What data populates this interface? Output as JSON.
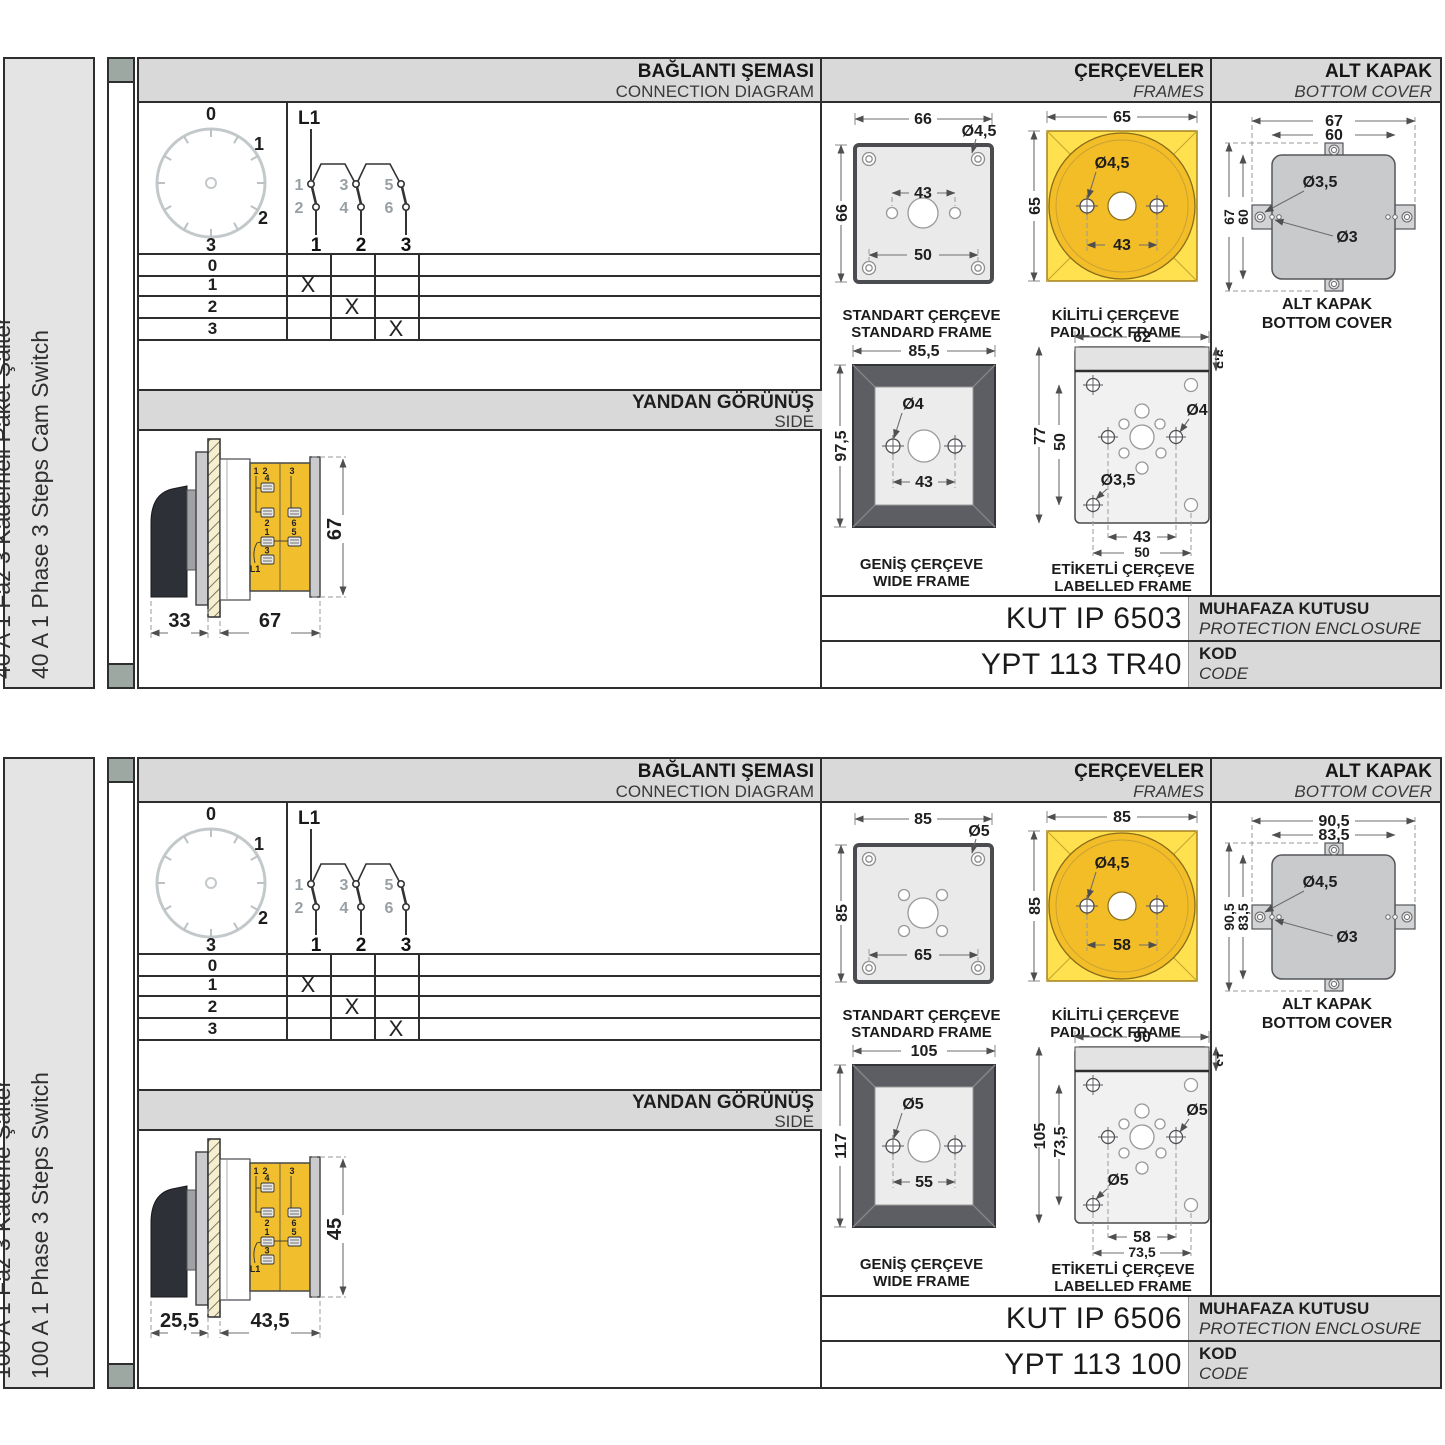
{
  "panels": [
    {
      "side_label_tr": "40 A 1 Faz 3 Kademeli Paket Şalter",
      "side_label_en": "40 A 1 Phase 3 Steps Cam Switch",
      "headers": {
        "connection_tr": "BAĞLANTI ŞEMASI",
        "connection_en": "CONNECTION DIAGRAM",
        "frames_tr": "ÇERÇEVELER",
        "frames_en": "FRAMES",
        "cover_tr": "ALT KAPAK",
        "cover_en": "BOTTOM COVER",
        "side_tr": "YANDAN GÖRÜNÜŞ",
        "side_en": "SIDE"
      },
      "dial": {
        "p0": "0",
        "p1": "1",
        "p2": "2",
        "p3": "3"
      },
      "circuit": {
        "source": "L1",
        "t1": "1",
        "t3": "3",
        "t5": "5",
        "b2": "2",
        "b4": "4",
        "b6": "6",
        "pole1": "1",
        "pole2": "2",
        "pole3": "3"
      },
      "table": {
        "rows": [
          {
            "pos": "0",
            "c1": "",
            "c2": "",
            "c3": ""
          },
          {
            "pos": "1",
            "c1": "X",
            "c2": "",
            "c3": ""
          },
          {
            "pos": "2",
            "c1": "",
            "c2": "X",
            "c3": ""
          },
          {
            "pos": "3",
            "c1": "",
            "c2": "",
            "c3": "X"
          }
        ]
      },
      "side_view": {
        "dim_front": "33",
        "dim_body": "67",
        "dim_height": "67",
        "lbl_1": "1",
        "lbl_2": "2",
        "lbl_3top": "3",
        "lbl_4": "4",
        "lbl_2b": "2",
        "lbl_6": "6",
        "lbl_1b": "1",
        "lbl_5": "5",
        "lbl_3b": "3",
        "lbl_l1": "L1"
      },
      "frames": {
        "standard": {
          "cap_tr": "STANDART ÇERÇEVE",
          "cap_en": "STANDARD FRAME",
          "dim_w": "66",
          "dim_h": "66",
          "dim_hole": "Ø4,5",
          "dim_mid": "43",
          "dim_bottom": "50"
        },
        "padlock": {
          "cap_tr": "KİLİTLİ ÇERÇEVE",
          "cap_en": "PADLOCK FRAME",
          "dim_w": "65",
          "dim_h": "65",
          "dim_hole": "Ø4,5",
          "dim_span": "43"
        },
        "wide": {
          "cap_tr": "GENİŞ ÇERÇEVE",
          "cap_en": "WIDE FRAME",
          "dim_w": "85,5",
          "dim_h": "97,5",
          "dim_hole": "Ø4",
          "dim_span": "43"
        },
        "labelled": {
          "cap_tr": "ETİKETLİ ÇERÇEVE",
          "cap_en": "LABELLED FRAME",
          "dim_w": "62",
          "dim_strip": "9,5",
          "dim_h": "77",
          "dim_inner": "50",
          "dim_hole_mid": "Ø4",
          "dim_hole_corner": "Ø3,5",
          "dim_span_mid": "43",
          "dim_span_corner": "50"
        }
      },
      "cover": {
        "cap_tr": "ALT KAPAK",
        "cap_en": "BOTTOM COVER",
        "dim_ow": "67",
        "dim_iw": "60",
        "dim_oh": "67",
        "dim_ih": "60",
        "dim_hole_big": "Ø3,5",
        "dim_hole_small": "Ø3"
      },
      "enclosure": {
        "value": "KUT IP 6503",
        "label_tr": "MUHAFAZA KUTUSU",
        "label_en": "PROTECTION ENCLOSURE"
      },
      "code": {
        "value": "YPT 113 TR40",
        "label_tr": "KOD",
        "label_en": "CODE"
      }
    },
    {
      "side_label_tr": "100 A 1 Faz 3 Kademe Şalter",
      "side_label_en": "100 A 1 Phase 3 Steps Switch",
      "headers": {
        "connection_tr": "BAĞLANTI ŞEMASI",
        "connection_en": "CONNECTION DIAGRAM",
        "frames_tr": "ÇERÇEVELER",
        "frames_en": "FRAMES",
        "cover_tr": "ALT KAPAK",
        "cover_en": "BOTTOM COVER",
        "side_tr": "YANDAN GÖRÜNÜŞ",
        "side_en": "SIDE"
      },
      "dial": {
        "p0": "0",
        "p1": "1",
        "p2": "2",
        "p3": "3"
      },
      "circuit": {
        "source": "L1",
        "t1": "1",
        "t3": "3",
        "t5": "5",
        "b2": "2",
        "b4": "4",
        "b6": "6",
        "pole1": "1",
        "pole2": "2",
        "pole3": "3"
      },
      "table": {
        "rows": [
          {
            "pos": "0",
            "c1": "",
            "c2": "",
            "c3": ""
          },
          {
            "pos": "1",
            "c1": "X",
            "c2": "",
            "c3": ""
          },
          {
            "pos": "2",
            "c1": "",
            "c2": "X",
            "c3": ""
          },
          {
            "pos": "3",
            "c1": "",
            "c2": "",
            "c3": "X"
          }
        ]
      },
      "side_view": {
        "dim_front": "25,5",
        "dim_body": "43,5",
        "dim_height": "45",
        "lbl_1": "1",
        "lbl_2": "2",
        "lbl_3top": "3",
        "lbl_4": "4",
        "lbl_2b": "2",
        "lbl_6": "6",
        "lbl_1b": "1",
        "lbl_5": "5",
        "lbl_3b": "3",
        "lbl_l1": "L1"
      },
      "frames": {
        "standard": {
          "cap_tr": "STANDART ÇERÇEVE",
          "cap_en": "STANDARD FRAME",
          "dim_w": "85",
          "dim_h": "85",
          "dim_hole": "Ø5",
          "dim_mid": "",
          "dim_bottom": "65"
        },
        "padlock": {
          "cap_tr": "KİLİTLİ ÇERÇEVE",
          "cap_en": "PADLOCK FRAME",
          "dim_w": "85",
          "dim_h": "85",
          "dim_hole": "Ø4,5",
          "dim_span": "58"
        },
        "wide": {
          "cap_tr": "GENİŞ ÇERÇEVE",
          "cap_en": "WIDE FRAME",
          "dim_w": "105",
          "dim_h": "117",
          "dim_hole": "Ø5",
          "dim_span": "55"
        },
        "labelled": {
          "cap_tr": "ETİKETLİ ÇERÇEVE",
          "cap_en": "LABELLED FRAME",
          "dim_w": "90",
          "dim_strip": "13",
          "dim_h": "105",
          "dim_inner": "73,5",
          "dim_hole_mid": "Ø5",
          "dim_hole_corner": "Ø5",
          "dim_span_mid": "58",
          "dim_span_corner": "73,5"
        }
      },
      "cover": {
        "cap_tr": "ALT KAPAK",
        "cap_en": "BOTTOM COVER",
        "dim_ow": "90,5",
        "dim_iw": "83,5",
        "dim_oh": "90,5",
        "dim_ih": "83,5",
        "dim_hole_big": "Ø4,5",
        "dim_hole_small": "Ø3"
      },
      "enclosure": {
        "value": "KUT IP 6506",
        "label_tr": "MUHAFAZA KUTUSU",
        "label_en": "PROTECTION ENCLOSURE"
      },
      "code": {
        "value": "YPT 113 100",
        "label_tr": "KOD",
        "label_en": "CODE"
      }
    }
  ]
}
